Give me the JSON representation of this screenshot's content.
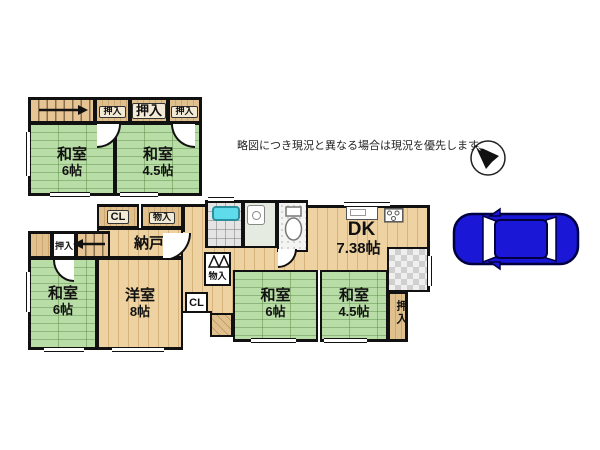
{
  "disclaimer": "略図につき現況と異なる場合は現況を優先します",
  "compass": {
    "label": "N"
  },
  "floor2": {
    "closets": [
      {
        "label": "押入"
      },
      {
        "label": "押入"
      },
      {
        "label": "押入"
      }
    ],
    "rooms": [
      {
        "name": "和室",
        "size": "6帖"
      },
      {
        "name": "和室",
        "size": "4.5帖"
      }
    ]
  },
  "floor1": {
    "closet_cl": "CL",
    "closet_monoire": "物入",
    "nando": "納戸",
    "oshiire_left": "押入",
    "stair_arrow": "←",
    "rooms": [
      {
        "name": "和室",
        "size": "6帖"
      },
      {
        "name": "洋室",
        "size": "8帖"
      },
      {
        "name": "和室",
        "size": "6帖"
      },
      {
        "name": "和室",
        "size": "4.5帖"
      },
      {
        "name": "DK",
        "size": "7.38帖"
      }
    ],
    "closet_monoire_mid": "物入",
    "closet_cl_mid": "CL",
    "oshiire_right": "押入"
  },
  "colors": {
    "tatami_green": "#b9dda6",
    "wood_tan": "#eed2a2",
    "closet_tan": "#e0c08d",
    "bathtub_cyan": "#5fdcec",
    "car_blue": "#1a17d6",
    "wall_black": "#111111"
  }
}
